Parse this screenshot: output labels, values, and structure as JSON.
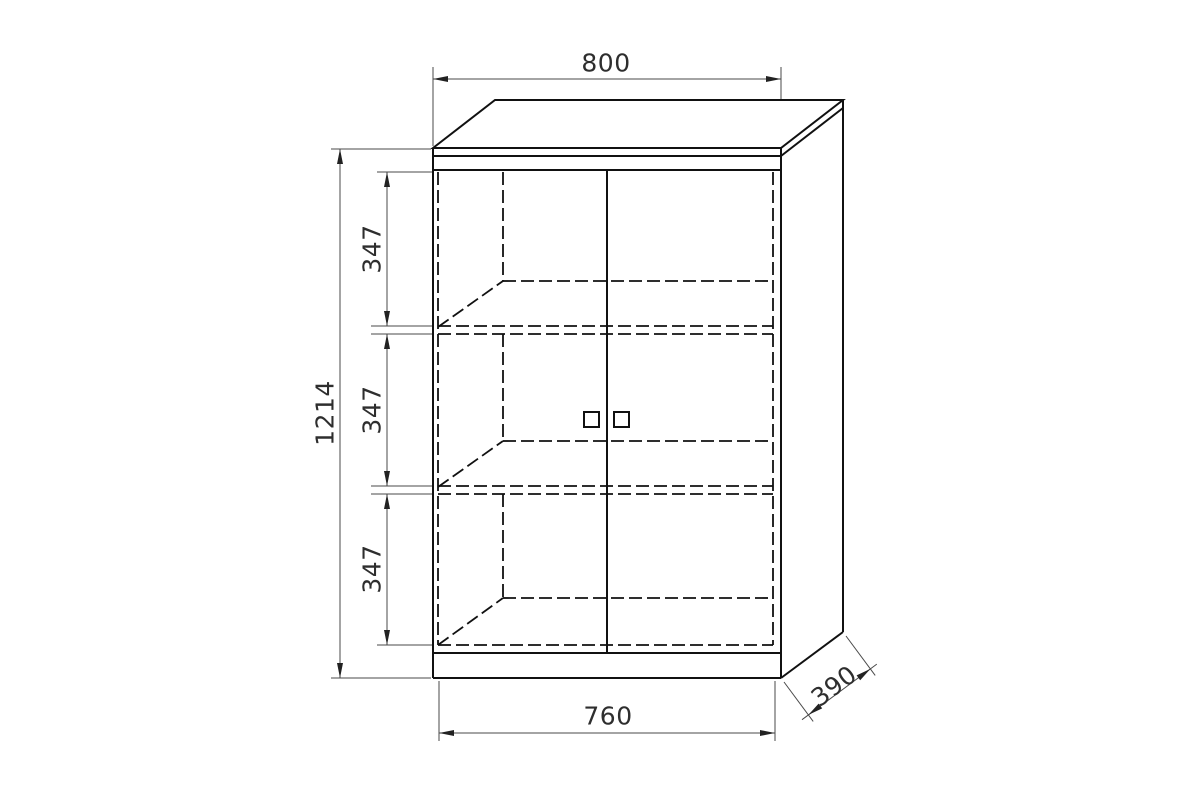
{
  "diagram": {
    "kind": "furniture-dimension-drawing",
    "subject": "two-door cabinet with two shelves",
    "dims": {
      "top_width": "800",
      "overall_height": "1214",
      "section_top": "347",
      "section_middle": "347",
      "section_bottom": "347",
      "bottom_inner_width": "760",
      "depth": "390"
    }
  }
}
